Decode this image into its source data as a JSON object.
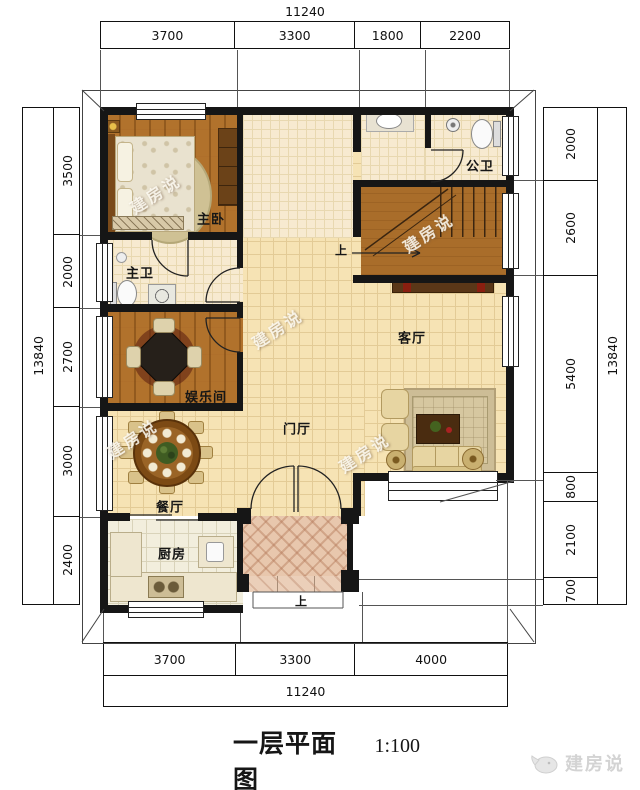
{
  "title": {
    "name": "一层平面图",
    "scale": "1:100",
    "area_label": "本层建筑面积: 134m²"
  },
  "dims": {
    "top_total": "11240",
    "top_segments": [
      "3700",
      "3300",
      "1800",
      "2200"
    ],
    "bottom_segments": [
      "3700",
      "3300",
      "4000"
    ],
    "bottom_total": "11240",
    "left_total": "13840",
    "left_segments": [
      "3500",
      "2000",
      "2700",
      "3000",
      "2400"
    ],
    "right_segments": [
      "2000",
      "2600",
      "5400",
      "800",
      "2100",
      "700"
    ],
    "right_total": "13840"
  },
  "rooms": {
    "master_bedroom": "主卧",
    "master_bath": "主卫",
    "entertainment": "娱乐间",
    "dining": "餐厅",
    "kitchen": "厨房",
    "foyer": "门厅",
    "living": "客厅",
    "public_bath": "公卫"
  },
  "stairs": {
    "up_label": "上"
  },
  "porch": {
    "up_label": "上"
  },
  "watermark": {
    "text": "建房说"
  },
  "logo": {
    "text": "建房说"
  },
  "colors": {
    "wall": "#161616",
    "wood_floor": "#b1722c",
    "hall_tile": "#f6e3b4",
    "bath_tile": "#f7ead0",
    "kitchen_tile": "#f2eedd",
    "porch_tile": "#e8c7ad",
    "dim_text": "#111111",
    "watermark_text": "#fffdf5",
    "logo_text": "#d3d3d3"
  }
}
